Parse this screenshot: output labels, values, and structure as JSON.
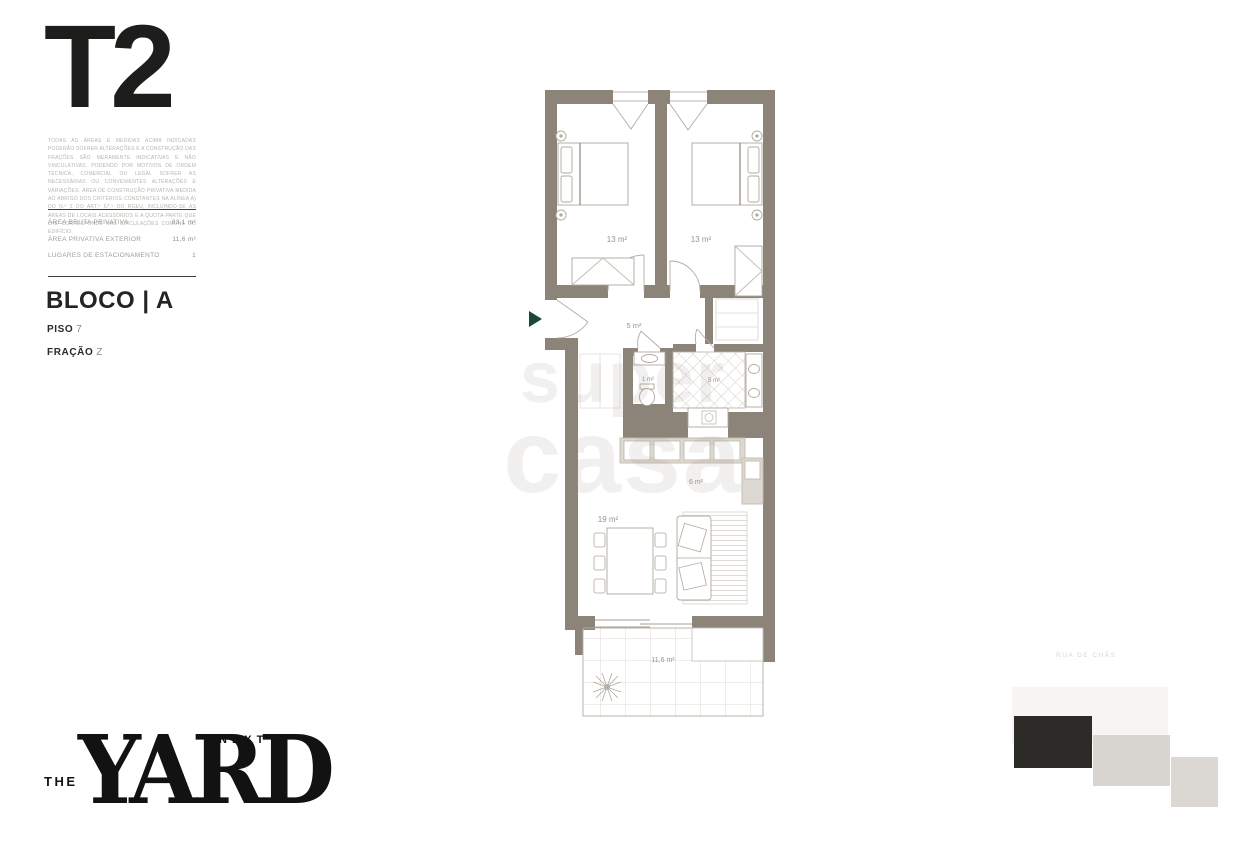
{
  "left_panel": {
    "typology": "T2",
    "disclaimer": "TODAS AS ÁREAS E MEDIDAS ACIMA INDICADAS PODERÃO SOFRER ALTERAÇÕES E A CONSTRUÇÃO DAS FRAÇÕES SÃO MERAMENTE INDICATIVAS E NÃO VINCULATIVAS, PODENDO POR MOTIVOS DE ORDEM TÉCNICA, COMERCIAL OU LEGAL SOFRER AS NECESSÁRIAS OU CONVENIENTES ALTERAÇÕES E VARIAÇÕES. ÁREA DE CONSTRUÇÃO PRIVATIVA MEDIDA AO ABRIGO DOS CRITÉRIOS CONSTANTES NA ALÍNEA A) DO N.º 2 DO ART.º 67.º DO RGEU, INCLUINDO-SE AS ÁREAS DE LOCAIS ACESSÓRIOS E A QUOTA-PARTE QUE LHE CORRESPONDE NAS CIRCULAÇÕES COMUNS DO EDIFÍCIO.",
    "areas": {
      "rows": [
        {
          "label": "ÁREA BRUTA PRIVATIVA",
          "value": "83,1 m²"
        },
        {
          "label": "ÁREA PRIVATIVA EXTERIOR",
          "value": "11,6 m²"
        },
        {
          "label": "LUGARES DE ESTACIONAMENTO",
          "value": "1"
        }
      ]
    },
    "block_label": "BLOCO | A",
    "floor": {
      "label": "PISO",
      "value": "7"
    },
    "fraction": {
      "label": "FRAÇÃO",
      "value": "Z"
    }
  },
  "floor_plan": {
    "labels": {
      "bedroom1": "13 m²",
      "bedroom2": "13 m²",
      "hall": "5 m²",
      "wc": "1 m²",
      "bathroom": "5 m²",
      "kitchen": "6 m²",
      "living": "19 m²",
      "balcony": "11,6 m²"
    },
    "colors": {
      "wall": "#8d8479",
      "furniture_line": "#b0a99e",
      "label_text": "#9b948a",
      "entry_arrow": "#17493a"
    },
    "watermark": {
      "line1": "super",
      "line2": "casa"
    }
  },
  "key_plan": {
    "street": "RUA DE CHÃS",
    "blocks": {
      "faint": "#f6f5f3",
      "highlighted": "#2d2b28",
      "gray1": "#d9d5d0",
      "gray2": "#dbd7d2"
    }
  },
  "logo": {
    "the": "THE",
    "yard": "YARD",
    "next": "NEXT"
  }
}
